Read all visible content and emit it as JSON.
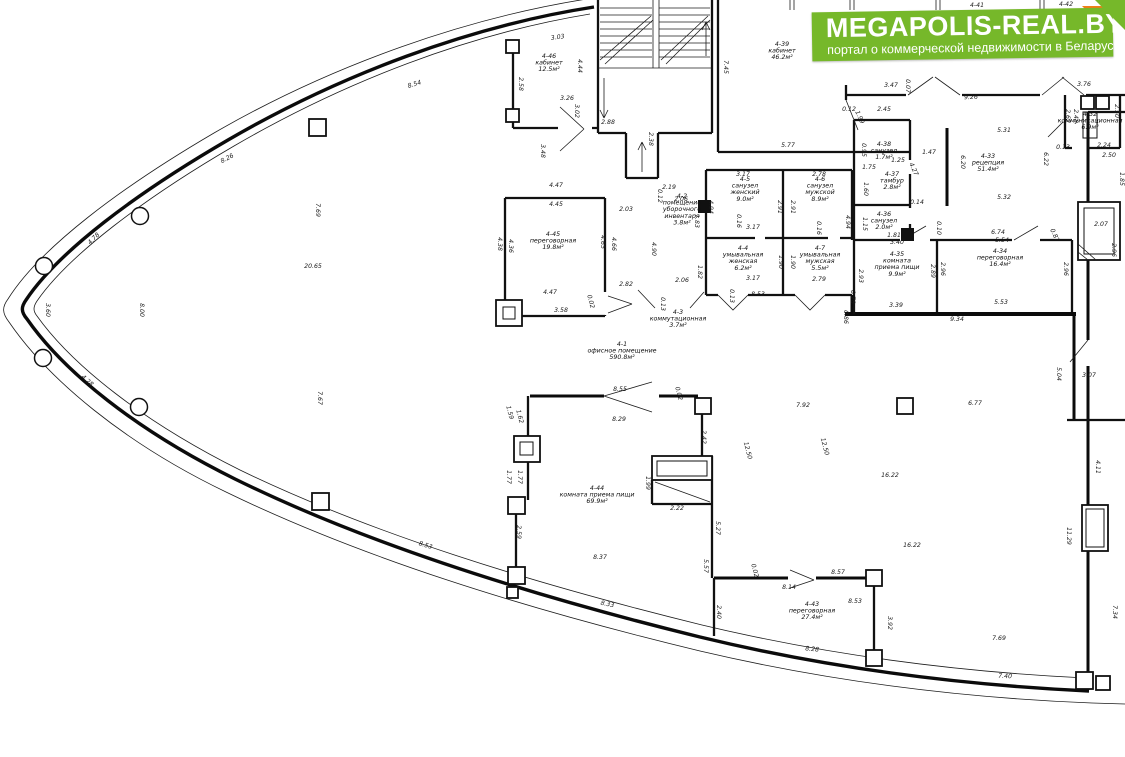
{
  "watermark": {
    "title": "MEGAPOLIS-REAL.BY",
    "subtitle": "портал о коммерческой недвижимости в Беларуси",
    "brand_green": "#76b82a",
    "fold_orange": "#ef8018"
  },
  "plan": {
    "rooms": [
      {
        "id": "4-46",
        "name": [
          "кабинет"
        ],
        "area": "12.5м²",
        "x": 549,
        "y": 58
      },
      {
        "id": "4-39",
        "name": [
          "кабинет"
        ],
        "area": "46.2м²",
        "x": 782,
        "y": 46
      },
      {
        "id": "4-45",
        "name": [
          "переговорная"
        ],
        "area": "19.8м²",
        "x": 553,
        "y": 236
      },
      {
        "id": "4-2",
        "name": [
          "помещение",
          "уборочного",
          "инвентаря"
        ],
        "area": "3.8м²",
        "x": 682,
        "y": 198
      },
      {
        "id": "4-3",
        "name": [
          "коммутационная"
        ],
        "area": "3.7м²",
        "x": 678,
        "y": 314
      },
      {
        "id": "4-1",
        "name": [
          "офисное помещение"
        ],
        "area": "590.8м²",
        "x": 622,
        "y": 346
      },
      {
        "id": "4-5",
        "name": [
          "санузел",
          "женский"
        ],
        "area": "9.0м²",
        "x": 745,
        "y": 181
      },
      {
        "id": "4-6",
        "name": [
          "санузел",
          "мужской"
        ],
        "area": "8.9м²",
        "x": 820,
        "y": 181
      },
      {
        "id": "4-4",
        "name": [
          "умывальная",
          "женская"
        ],
        "area": "6.2м²",
        "x": 743,
        "y": 250
      },
      {
        "id": "4-7",
        "name": [
          "умывальная",
          "мужская"
        ],
        "area": "5.5м²",
        "x": 820,
        "y": 250
      },
      {
        "id": "4-38",
        "name": [
          "санузел"
        ],
        "area": "1.7м²",
        "x": 884,
        "y": 146
      },
      {
        "id": "4-37",
        "name": [
          "тамбур"
        ],
        "area": "2.8м²",
        "x": 892,
        "y": 176
      },
      {
        "id": "4-36",
        "name": [
          "санузел"
        ],
        "area": "2.0м²",
        "x": 884,
        "y": 216
      },
      {
        "id": "4-33",
        "name": [
          "рецепция"
        ],
        "area": "51.4м²",
        "x": 988,
        "y": 158
      },
      {
        "id": "4-32",
        "name": [
          "коммуникационная"
        ],
        "area": "6.9м²",
        "x": 1090,
        "y": 116
      },
      {
        "id": "4-35",
        "name": [
          "комната",
          "приема пищи"
        ],
        "area": "9.9м²",
        "x": 897,
        "y": 256
      },
      {
        "id": "4-34",
        "name": [
          "переговорная"
        ],
        "area": "16.4м²",
        "x": 1000,
        "y": 253
      },
      {
        "id": "4-44",
        "name": [
          "комната приема пищи"
        ],
        "area": "69.9м²",
        "x": 597,
        "y": 490
      },
      {
        "id": "4-43",
        "name": [
          "переговорная"
        ],
        "area": "27.4м²",
        "x": 812,
        "y": 606
      }
    ],
    "top_labels": [
      {
        "t": "4-41",
        "x": 977,
        "y": 7
      },
      {
        "t": "4-42",
        "x": 1066,
        "y": 6
      }
    ],
    "dims": [
      {
        "t": "8.54",
        "x": 415,
        "y": 86,
        "r": -17
      },
      {
        "t": "8.26",
        "x": 228,
        "y": 160,
        "r": -28
      },
      {
        "t": "4.78",
        "x": 95,
        "y": 240,
        "r": -45
      },
      {
        "t": "3.60",
        "x": 46,
        "y": 310,
        "r": 90
      },
      {
        "t": "4.28",
        "x": 86,
        "y": 382,
        "r": 42
      },
      {
        "t": "8.00",
        "x": 140,
        "y": 310,
        "r": 90
      },
      {
        "t": "7.69",
        "x": 316,
        "y": 210,
        "r": 90
      },
      {
        "t": "20.65",
        "x": 313,
        "y": 268
      },
      {
        "t": "7.67",
        "x": 318,
        "y": 398,
        "r": 90
      },
      {
        "t": "8.53",
        "x": 425,
        "y": 547,
        "r": 17
      },
      {
        "t": "8.33",
        "x": 607,
        "y": 606,
        "r": 12
      },
      {
        "t": "8.28",
        "x": 812,
        "y": 651,
        "r": 6
      },
      {
        "t": "7.40",
        "x": 1005,
        "y": 678,
        "r": 2
      },
      {
        "t": "7.69",
        "x": 999,
        "y": 640
      },
      {
        "t": "7.34",
        "x": 1113,
        "y": 612,
        "r": 90
      },
      {
        "t": "3.03",
        "x": 558,
        "y": 39,
        "r": -8
      },
      {
        "t": "2.58",
        "x": 519,
        "y": 84,
        "r": 90
      },
      {
        "t": "3.26",
        "x": 567,
        "y": 100
      },
      {
        "t": "3.02",
        "x": 575,
        "y": 111,
        "r": 90
      },
      {
        "t": "2.88",
        "x": 608,
        "y": 124
      },
      {
        "t": "2.38",
        "x": 649,
        "y": 139,
        "r": 90
      },
      {
        "t": "3.48",
        "x": 541,
        "y": 151,
        "r": 90
      },
      {
        "t": "4.44",
        "x": 578,
        "y": 66,
        "r": 90
      },
      {
        "t": "7.45",
        "x": 724,
        "y": 67,
        "r": 90
      },
      {
        "t": "5.77",
        "x": 788,
        "y": 147
      },
      {
        "t": "4.47",
        "x": 556,
        "y": 187
      },
      {
        "t": "4.45",
        "x": 556,
        "y": 206
      },
      {
        "t": "4.38",
        "x": 498,
        "y": 244,
        "r": 90
      },
      {
        "t": "4.36",
        "x": 509,
        "y": 246,
        "r": 90
      },
      {
        "t": "4.65",
        "x": 601,
        "y": 242,
        "r": 90
      },
      {
        "t": "4.66",
        "x": 612,
        "y": 244,
        "r": 90
      },
      {
        "t": "4.47",
        "x": 550,
        "y": 294
      },
      {
        "t": "3.58",
        "x": 561,
        "y": 312
      },
      {
        "t": "0.02",
        "x": 589,
        "y": 302,
        "r": 75
      },
      {
        "t": "2.03",
        "x": 626,
        "y": 211
      },
      {
        "t": "2.82",
        "x": 626,
        "y": 286
      },
      {
        "t": "2.19",
        "x": 669,
        "y": 189
      },
      {
        "t": "2.06",
        "x": 681,
        "y": 201
      },
      {
        "t": "0.12",
        "x": 658,
        "y": 196,
        "r": 90
      },
      {
        "t": "4.90",
        "x": 652,
        "y": 249,
        "r": 90
      },
      {
        "t": "1.83",
        "x": 695,
        "y": 221,
        "r": 90
      },
      {
        "t": "1.82",
        "x": 698,
        "y": 272,
        "r": 90
      },
      {
        "t": "2.06",
        "x": 682,
        "y": 282
      },
      {
        "t": "0.13",
        "x": 661,
        "y": 304,
        "r": 90
      },
      {
        "t": "3.17",
        "x": 743,
        "y": 176
      },
      {
        "t": "2.78",
        "x": 819,
        "y": 176
      },
      {
        "t": "2.91",
        "x": 778,
        "y": 207,
        "r": 90
      },
      {
        "t": "2.91",
        "x": 791,
        "y": 207,
        "r": 90
      },
      {
        "t": "4.94",
        "x": 709,
        "y": 207,
        "r": 90
      },
      {
        "t": "4.94",
        "x": 846,
        "y": 222,
        "r": 90
      },
      {
        "t": "0.16",
        "x": 737,
        "y": 221,
        "r": 90
      },
      {
        "t": "0.16",
        "x": 817,
        "y": 228,
        "r": 90
      },
      {
        "t": "3.17",
        "x": 753,
        "y": 229
      },
      {
        "t": "3.17",
        "x": 753,
        "y": 280
      },
      {
        "t": "2.79",
        "x": 819,
        "y": 281
      },
      {
        "t": "1.90",
        "x": 779,
        "y": 262,
        "r": 90
      },
      {
        "t": "1.90",
        "x": 791,
        "y": 262,
        "r": 90
      },
      {
        "t": "8.53",
        "x": 758,
        "y": 296
      },
      {
        "t": "0.13",
        "x": 730,
        "y": 296,
        "r": 90
      },
      {
        "t": "0.78",
        "x": 851,
        "y": 297,
        "r": 90
      },
      {
        "t": "2.45",
        "x": 884,
        "y": 111
      },
      {
        "t": "1.75",
        "x": 869,
        "y": 169
      },
      {
        "t": "1.25",
        "x": 898,
        "y": 162
      },
      {
        "t": "0.95",
        "x": 862,
        "y": 150,
        "r": 90
      },
      {
        "t": "1.60",
        "x": 864,
        "y": 189,
        "r": 90
      },
      {
        "t": "1.15",
        "x": 863,
        "y": 224,
        "r": 90
      },
      {
        "t": "1.81",
        "x": 894,
        "y": 237
      },
      {
        "t": "4.27",
        "x": 912,
        "y": 170,
        "r": 65
      },
      {
        "t": "0.14",
        "x": 917,
        "y": 204
      },
      {
        "t": "3.47",
        "x": 891,
        "y": 87
      },
      {
        "t": "0.07",
        "x": 906,
        "y": 86,
        "r": 90
      },
      {
        "t": "9.26",
        "x": 971,
        "y": 99,
        "r": -2
      },
      {
        "t": "0.12",
        "x": 849,
        "y": 111
      },
      {
        "t": "1.99",
        "x": 858,
        "y": 118,
        "r": 65
      },
      {
        "t": "5.31",
        "x": 1004,
        "y": 132
      },
      {
        "t": "6.20",
        "x": 961,
        "y": 162,
        "r": 90
      },
      {
        "t": "5.32",
        "x": 1004,
        "y": 199
      },
      {
        "t": "1.47",
        "x": 929,
        "y": 154
      },
      {
        "t": "3.40",
        "x": 897,
        "y": 244
      },
      {
        "t": "3.39",
        "x": 896,
        "y": 307
      },
      {
        "t": "2.93",
        "x": 859,
        "y": 276,
        "r": 90
      },
      {
        "t": "2.89",
        "x": 931,
        "y": 271,
        "r": 90
      },
      {
        "t": "6.74",
        "x": 998,
        "y": 234
      },
      {
        "t": "0.87",
        "x": 1053,
        "y": 236,
        "r": 65
      },
      {
        "t": "5.54",
        "x": 1002,
        "y": 242
      },
      {
        "t": "5.53",
        "x": 1001,
        "y": 304
      },
      {
        "t": "2.96",
        "x": 941,
        "y": 269,
        "r": 90
      },
      {
        "t": "2.96",
        "x": 1064,
        "y": 269,
        "r": 90
      },
      {
        "t": "9.34",
        "x": 957,
        "y": 321
      },
      {
        "t": "0.86",
        "x": 844,
        "y": 317,
        "r": 90
      },
      {
        "t": "0.10",
        "x": 937,
        "y": 228,
        "r": 90
      },
      {
        "t": "3.76",
        "x": 1084,
        "y": 86
      },
      {
        "t": "2.62",
        "x": 1066,
        "y": 116,
        "r": 90
      },
      {
        "t": "2.48",
        "x": 1074,
        "y": 116,
        "r": 90
      },
      {
        "t": "2.50",
        "x": 1115,
        "y": 111,
        "r": 90
      },
      {
        "t": "0.13",
        "x": 1063,
        "y": 149
      },
      {
        "t": "2.24",
        "x": 1104,
        "y": 147
      },
      {
        "t": "2.50",
        "x": 1109,
        "y": 157
      },
      {
        "t": "6.22",
        "x": 1044,
        "y": 159,
        "r": 90
      },
      {
        "t": "1.85",
        "x": 1120,
        "y": 179,
        "r": 90
      },
      {
        "t": "2.07",
        "x": 1101,
        "y": 226
      },
      {
        "t": "2.96",
        "x": 1112,
        "y": 250,
        "r": 90
      },
      {
        "t": "7.00",
        "x": 1118,
        "y": 16,
        "r": 90
      },
      {
        "t": "7.92",
        "x": 803,
        "y": 407
      },
      {
        "t": "12.50",
        "x": 746,
        "y": 451,
        "r": 75
      },
      {
        "t": "12.50",
        "x": 823,
        "y": 447,
        "r": 75
      },
      {
        "t": "16.22",
        "x": 890,
        "y": 477
      },
      {
        "t": "16.22",
        "x": 912,
        "y": 547
      },
      {
        "t": "6.77",
        "x": 975,
        "y": 405
      },
      {
        "t": "5.04",
        "x": 1057,
        "y": 374,
        "r": 90
      },
      {
        "t": "3.07",
        "x": 1089,
        "y": 377
      },
      {
        "t": "4.11",
        "x": 1096,
        "y": 467,
        "r": 90
      },
      {
        "t": "11.29",
        "x": 1067,
        "y": 536,
        "r": 90
      },
      {
        "t": "8.55",
        "x": 620,
        "y": 391
      },
      {
        "t": "0.02",
        "x": 677,
        "y": 394,
        "r": 75
      },
      {
        "t": "8.29",
        "x": 619,
        "y": 421
      },
      {
        "t": "1.59",
        "x": 508,
        "y": 413,
        "r": 75
      },
      {
        "t": "1.62",
        "x": 518,
        "y": 417,
        "r": 75
      },
      {
        "t": "2.42",
        "x": 702,
        "y": 437,
        "r": 90
      },
      {
        "t": "1.77",
        "x": 507,
        "y": 477,
        "r": 90
      },
      {
        "t": "1.77",
        "x": 518,
        "y": 477,
        "r": 90
      },
      {
        "t": "1.99",
        "x": 646,
        "y": 483,
        "r": 90
      },
      {
        "t": "2.22",
        "x": 677,
        "y": 510
      },
      {
        "t": "5.27",
        "x": 716,
        "y": 528,
        "r": 90
      },
      {
        "t": "2.59",
        "x": 517,
        "y": 532,
        "r": 90
      },
      {
        "t": "8.37",
        "x": 600,
        "y": 559
      },
      {
        "t": "8.57",
        "x": 838,
        "y": 574
      },
      {
        "t": "0.02",
        "x": 753,
        "y": 571,
        "r": 75
      },
      {
        "t": "8.14",
        "x": 789,
        "y": 589
      },
      {
        "t": "8.53",
        "x": 855,
        "y": 603
      },
      {
        "t": "2.40",
        "x": 717,
        "y": 612,
        "r": 90
      },
      {
        "t": "3.92",
        "x": 888,
        "y": 623,
        "r": 90
      },
      {
        "t": "5.57",
        "x": 704,
        "y": 566,
        "r": 90
      }
    ]
  }
}
